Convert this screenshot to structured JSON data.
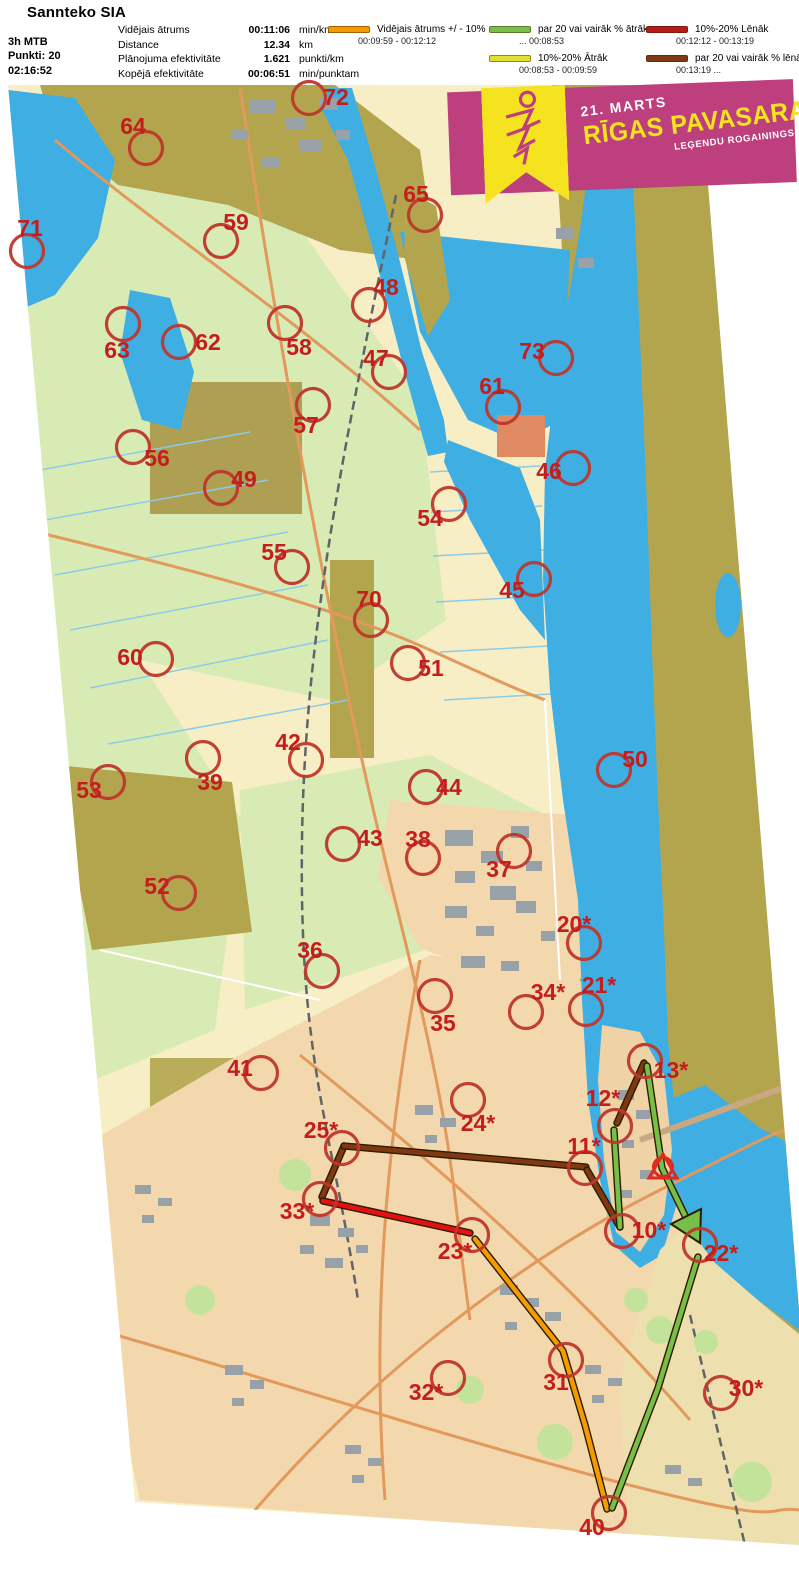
{
  "header": {
    "title": "Sannteko SIA",
    "left_lines": [
      "3h MTB",
      "Punkti: 20",
      "02:16:52"
    ],
    "stats": [
      {
        "label": "Vidējais ātrums",
        "value": "00:11:06",
        "unit": "min/km"
      },
      {
        "label": "Distance",
        "value": "12.34",
        "unit": "km"
      },
      {
        "label": "Plānojuma efektivitāte",
        "value": "1.621",
        "unit": "punkti/km"
      },
      {
        "label": "Kopējā efektivitāte",
        "value": "00:06:51",
        "unit": "min/punktam"
      }
    ],
    "legend": [
      {
        "label": "Vidējais ātrums +/ - 10%",
        "range": "00:09:59  -  00:12:12",
        "color": "#F49B00"
      },
      {
        "label": "par 20 vai vairāk % ātrāk",
        "range": "...  00:08:53",
        "color": "#76C04A"
      },
      {
        "label": "10%-20% Ātrāk",
        "range": "00:08:53  -  00:09:59",
        "color": "#E3DF2E"
      },
      {
        "label": "10%-20% Lēnāk",
        "range": "00:12:12  -  00:13:19",
        "color": "#B71A1A"
      },
      {
        "label": "par 20 vai vairāk % lēnāk",
        "range": "00:13:19  ...",
        "color": "#7E3B12"
      }
    ]
  },
  "banner": {
    "date": "21. MARTS",
    "title": "RĪGAS PAVASARA",
    "subtitle": "LEĢENDU ROGAININGS",
    "bg": "#BE3F7E",
    "accent": "#F5E320"
  },
  "map": {
    "category_colors": {
      "avg": "#F49B00",
      "fast20": "#76C04A",
      "fast10": "#E3DF2E",
      "slow10": "#E51010",
      "slow20": "#803810"
    },
    "controls": [
      {
        "n": "72",
        "cx": 309,
        "cy": 98,
        "lx": 336,
        "ly": 97
      },
      {
        "n": "64",
        "cx": 146,
        "cy": 148,
        "lx": 133,
        "ly": 126
      },
      {
        "n": "65",
        "cx": 425,
        "cy": 215,
        "lx": 416,
        "ly": 194
      },
      {
        "n": "71",
        "cx": 27,
        "cy": 251,
        "lx": 30,
        "ly": 228
      },
      {
        "n": "59",
        "cx": 221,
        "cy": 241,
        "lx": 236,
        "ly": 222
      },
      {
        "n": "48",
        "cx": 369,
        "cy": 305,
        "lx": 386,
        "ly": 287
      },
      {
        "n": "63",
        "cx": 123,
        "cy": 324,
        "lx": 117,
        "ly": 350
      },
      {
        "n": "62",
        "cx": 179,
        "cy": 342,
        "lx": 208,
        "ly": 342
      },
      {
        "n": "58",
        "cx": 285,
        "cy": 323,
        "lx": 299,
        "ly": 347
      },
      {
        "n": "47",
        "cx": 389,
        "cy": 372,
        "lx": 376,
        "ly": 358
      },
      {
        "n": "73",
        "cx": 556,
        "cy": 358,
        "lx": 532,
        "ly": 351
      },
      {
        "n": "61",
        "cx": 503,
        "cy": 407,
        "lx": 492,
        "ly": 386
      },
      {
        "n": "57",
        "cx": 313,
        "cy": 405,
        "lx": 306,
        "ly": 425
      },
      {
        "n": "56",
        "cx": 133,
        "cy": 447,
        "lx": 157,
        "ly": 458
      },
      {
        "n": "49",
        "cx": 221,
        "cy": 488,
        "lx": 244,
        "ly": 479
      },
      {
        "n": "46",
        "cx": 573,
        "cy": 468,
        "lx": 549,
        "ly": 471
      },
      {
        "n": "54",
        "cx": 449,
        "cy": 504,
        "lx": 430,
        "ly": 518
      },
      {
        "n": "55",
        "cx": 292,
        "cy": 567,
        "lx": 274,
        "ly": 552
      },
      {
        "n": "45",
        "cx": 534,
        "cy": 579,
        "lx": 512,
        "ly": 590
      },
      {
        "n": "70",
        "cx": 371,
        "cy": 620,
        "lx": 369,
        "ly": 599
      },
      {
        "n": "60",
        "cx": 156,
        "cy": 659,
        "lx": 130,
        "ly": 657
      },
      {
        "n": "51",
        "cx": 408,
        "cy": 663,
        "lx": 431,
        "ly": 668
      },
      {
        "n": "50",
        "cx": 614,
        "cy": 770,
        "lx": 635,
        "ly": 759
      },
      {
        "n": "42",
        "cx": 306,
        "cy": 760,
        "lx": 288,
        "ly": 742
      },
      {
        "n": "39",
        "cx": 203,
        "cy": 758,
        "lx": 210,
        "ly": 782
      },
      {
        "n": "53",
        "cx": 108,
        "cy": 782,
        "lx": 89,
        "ly": 790
      },
      {
        "n": "44",
        "cx": 426,
        "cy": 787,
        "lx": 449,
        "ly": 787
      },
      {
        "n": "43",
        "cx": 343,
        "cy": 844,
        "lx": 370,
        "ly": 838
      },
      {
        "n": "38",
        "cx": 423,
        "cy": 858,
        "lx": 418,
        "ly": 839
      },
      {
        "n": "37",
        "cx": 514,
        "cy": 851,
        "lx": 499,
        "ly": 869
      },
      {
        "n": "52",
        "cx": 179,
        "cy": 893,
        "lx": 157,
        "ly": 886
      },
      {
        "n": "20*",
        "cx": 584,
        "cy": 943,
        "lx": 574,
        "ly": 924
      },
      {
        "n": "36",
        "cx": 322,
        "cy": 971,
        "lx": 310,
        "ly": 950
      },
      {
        "n": "35",
        "cx": 435,
        "cy": 996,
        "lx": 443,
        "ly": 1023
      },
      {
        "n": "34*",
        "cx": 526,
        "cy": 1012,
        "lx": 548,
        "ly": 992
      },
      {
        "n": "21*",
        "cx": 586,
        "cy": 1009,
        "lx": 599,
        "ly": 985
      },
      {
        "n": "13*",
        "cx": 645,
        "cy": 1061,
        "lx": 671,
        "ly": 1070
      },
      {
        "n": "41",
        "cx": 261,
        "cy": 1073,
        "lx": 240,
        "ly": 1068
      },
      {
        "n": "12*",
        "cx": 615,
        "cy": 1126,
        "lx": 603,
        "ly": 1098
      },
      {
        "n": "24*",
        "cx": 468,
        "cy": 1100,
        "lx": 478,
        "ly": 1123
      },
      {
        "n": "25*",
        "cx": 342,
        "cy": 1148,
        "lx": 321,
        "ly": 1130
      },
      {
        "n": "11*",
        "cx": 585,
        "cy": 1168,
        "lx": 584,
        "ly": 1146
      },
      {
        "n": "33*",
        "cx": 320,
        "cy": 1199,
        "lx": 297,
        "ly": 1211
      },
      {
        "n": "10*",
        "cx": 622,
        "cy": 1231,
        "lx": 649,
        "ly": 1230
      },
      {
        "n": "22*",
        "cx": 700,
        "cy": 1245,
        "lx": 721,
        "ly": 1253
      },
      {
        "n": "23*",
        "cx": 472,
        "cy": 1235,
        "lx": 455,
        "ly": 1251
      },
      {
        "n": "32*",
        "cx": 448,
        "cy": 1378,
        "lx": 426,
        "ly": 1392
      },
      {
        "n": "31",
        "cx": 566,
        "cy": 1360,
        "lx": 556,
        "ly": 1382
      },
      {
        "n": "30*",
        "cx": 721,
        "cy": 1393,
        "lx": 746,
        "ly": 1388
      },
      {
        "n": "40",
        "cx": 609,
        "cy": 1513,
        "lx": 592,
        "ly": 1527
      }
    ],
    "start_finish": {
      "x": 663,
      "y": 1167
    },
    "route": [
      {
        "from": "33*",
        "to": "25*",
        "cat": "slow20",
        "pts": [
          [
            322,
            1197
          ],
          [
            344,
            1146
          ]
        ]
      },
      {
        "from": "25*",
        "to": "11*",
        "cat": "slow20",
        "pts": [
          [
            344,
            1146
          ],
          [
            586,
            1167
          ]
        ]
      },
      {
        "from": "11*",
        "to": "10*",
        "cat": "slow20",
        "pts": [
          [
            587,
            1170
          ],
          [
            620,
            1227
          ]
        ]
      },
      {
        "from": "12*",
        "to": "13*",
        "cat": "slow20",
        "pts": [
          [
            617,
            1123
          ],
          [
            644,
            1063
          ]
        ]
      },
      {
        "from": "23*",
        "to": "33*",
        "cat": "slow10",
        "pts": [
          [
            470,
            1233
          ],
          [
            323,
            1201
          ]
        ]
      },
      {
        "from": "23*",
        "to": "40",
        "cat": "avg",
        "pts": [
          [
            475,
            1239
          ],
          [
            563,
            1351
          ],
          [
            585,
            1425
          ],
          [
            607,
            1509
          ]
        ]
      },
      {
        "from": "10*",
        "to": "12*",
        "cat": "fast20",
        "pts": [
          [
            620,
            1227
          ],
          [
            614,
            1130
          ]
        ]
      },
      {
        "from": "13*",
        "to": "22*",
        "cat": "fast20",
        "pts": [
          [
            647,
            1066
          ],
          [
            662,
            1168
          ],
          [
            691,
            1228
          ]
        ]
      },
      {
        "from": "22*",
        "to": "40",
        "cat": "fast20",
        "pts": [
          [
            698,
            1257
          ],
          [
            658,
            1388
          ],
          [
            612,
            1508
          ]
        ]
      }
    ],
    "arrow": {
      "points": "700,1243 671,1224 701,1209",
      "cat": "fast20"
    }
  }
}
